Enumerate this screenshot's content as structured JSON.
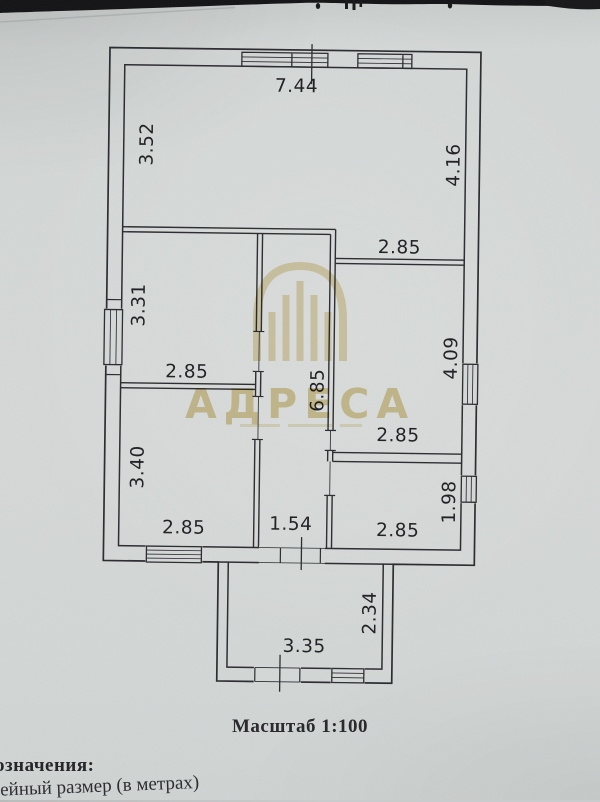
{
  "document": {
    "scale_caption": "Масштаб 1:100",
    "legend_heading_visible": "означения:",
    "legend_item_visible": "нейный размер (в метрах)"
  },
  "watermark": {
    "brand": "АДРЕСА",
    "color": "#dcc88a"
  },
  "floor_plan": {
    "dims": [
      {
        "id": "top-width",
        "value": "7.44"
      },
      {
        "id": "upper-left-depth",
        "value": "3.52"
      },
      {
        "id": "upper-right-depth",
        "value": "4.16"
      },
      {
        "id": "upper-right-room-width",
        "value": "2.85"
      },
      {
        "id": "mid-left-room-depth",
        "value": "3.31"
      },
      {
        "id": "mid-left-room-width",
        "value": "2.85"
      },
      {
        "id": "hall-length",
        "value": "6.85"
      },
      {
        "id": "mid-right-room-depth",
        "value": "4.09"
      },
      {
        "id": "mid-right-room-width",
        "value": "2.85"
      },
      {
        "id": "lower-left-room-depth",
        "value": "3.40"
      },
      {
        "id": "lower-left-room-width",
        "value": "2.85"
      },
      {
        "id": "hall-width",
        "value": "1.54"
      },
      {
        "id": "lower-right-room-width",
        "value": "2.85"
      },
      {
        "id": "lower-right-room-depth",
        "value": "1.98"
      },
      {
        "id": "porch-depth",
        "value": "2.34"
      },
      {
        "id": "porch-width",
        "value": "3.35"
      }
    ]
  }
}
